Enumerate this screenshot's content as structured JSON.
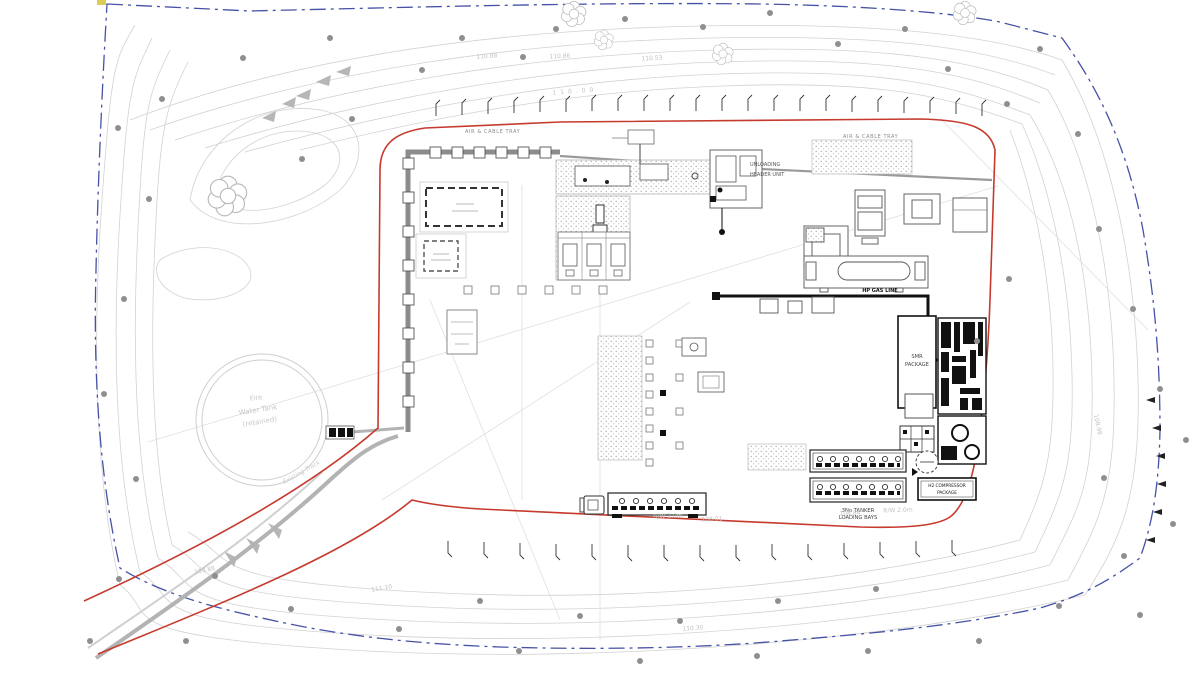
{
  "drawing": {
    "labels": {
      "air_cable_tray": "AIR & CABLE TRAY",
      "gas_line": "HP GAS LINE",
      "fire_water_tank_line1": "Fire",
      "fire_water_tank_line2": "Water Tank",
      "fire_water_tank_line3": "(retained)",
      "smr_line1": "SMR",
      "smr_line2": "PACKAGE",
      "h2_compressor_line1": "H2 COMPRESSOR",
      "h2_compressor_line2": "PACKAGE",
      "tanker_bays_line1": "3No TANKER",
      "tanker_bays_line2": "LOADING BAYS",
      "unloading_line1": "UNLOADING",
      "unloading_line2": "HEADER UNIT",
      "existing_track": "Existing Track"
    },
    "elevation_marks": [
      "110.88",
      "110.86",
      "110.53",
      "110.00",
      "108.98",
      "108.01",
      "108.84",
      "R/W 2.0m",
      "R/W 2.0m",
      "110.30",
      "111.10",
      "109.88"
    ],
    "colors": {
      "site_boundary_blue": "#4552a5",
      "fence_red": "#c63a2e",
      "contour_gray": "#cfcfcf",
      "road_gray": "#b3b3b3",
      "equipment_dark": "#222222"
    }
  }
}
